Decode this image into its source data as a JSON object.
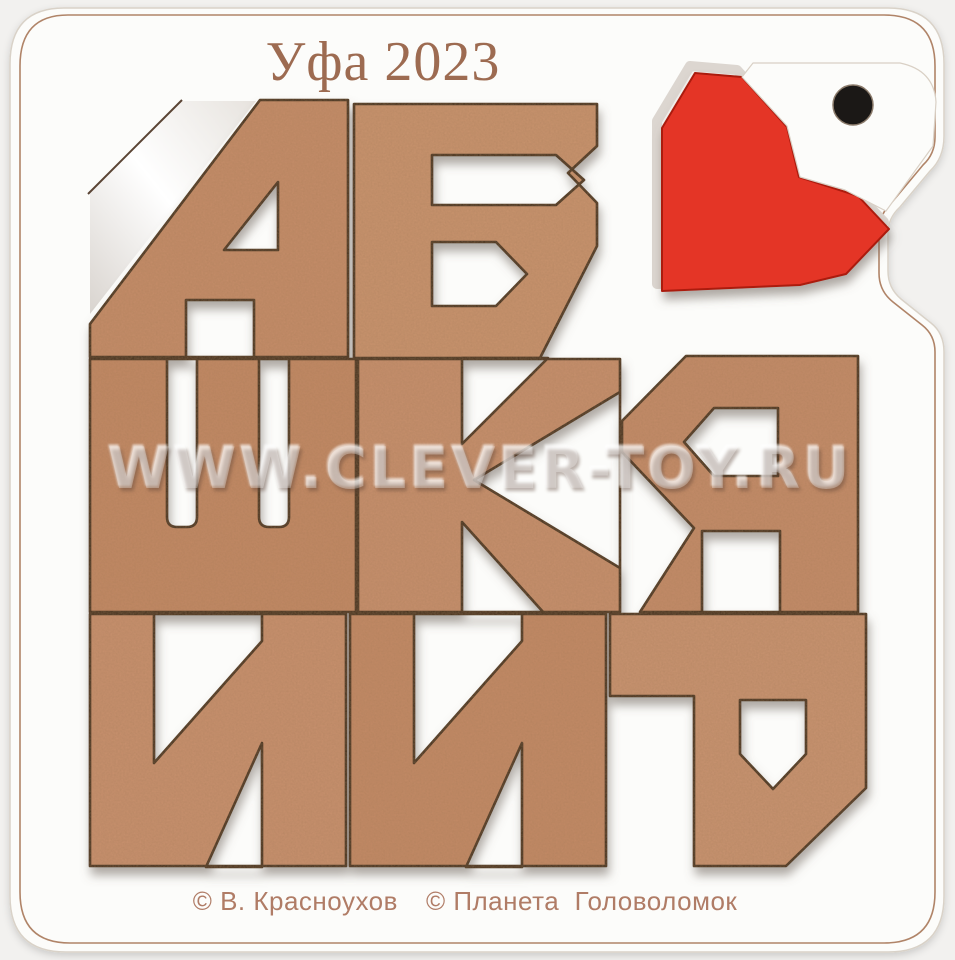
{
  "photo": {
    "edition_label": "Уфа 2023",
    "watermark": "WWW.CLEVER-TOY.RU",
    "credits": {
      "designer": "© В. Красноухов",
      "publisher": "© Планета  Головоломок"
    },
    "colors": {
      "background": "#f2f1ef",
      "board": "#fcfcfa",
      "engraved_line": "#b08468",
      "recess_floor": "#f5f3f0",
      "piece_outline": "#3a2a1d",
      "heart": "#e43427",
      "heart_edge": "#ab1a10",
      "hang_hole": "#1b1816",
      "title_text": "#9d6b51",
      "credits_text": "#b07c66",
      "shadow": "#6e645c"
    },
    "puzzle": {
      "pieces": [
        {
          "id": "a",
          "letter": "А"
        },
        {
          "id": "b",
          "letter": "Б"
        },
        {
          "id": "sh",
          "letter": "Ш"
        },
        {
          "id": "k",
          "letter": "К"
        },
        {
          "id": "ya",
          "letter": "Я"
        },
        {
          "id": "i1",
          "letter": "И"
        },
        {
          "id": "i2",
          "letter": "И"
        },
        {
          "id": "r",
          "letter": "Р"
        },
        {
          "id": "heart",
          "letter": "♥"
        }
      ],
      "wood_tones": {
        "a": "#c78e6a",
        "b": "#cb9470",
        "sh": "#c48a66",
        "k": "#c9916e",
        "ya": "#c68d6b",
        "i1": "#ca9270",
        "i2": "#c58b67",
        "r": "#cb9472"
      }
    }
  }
}
